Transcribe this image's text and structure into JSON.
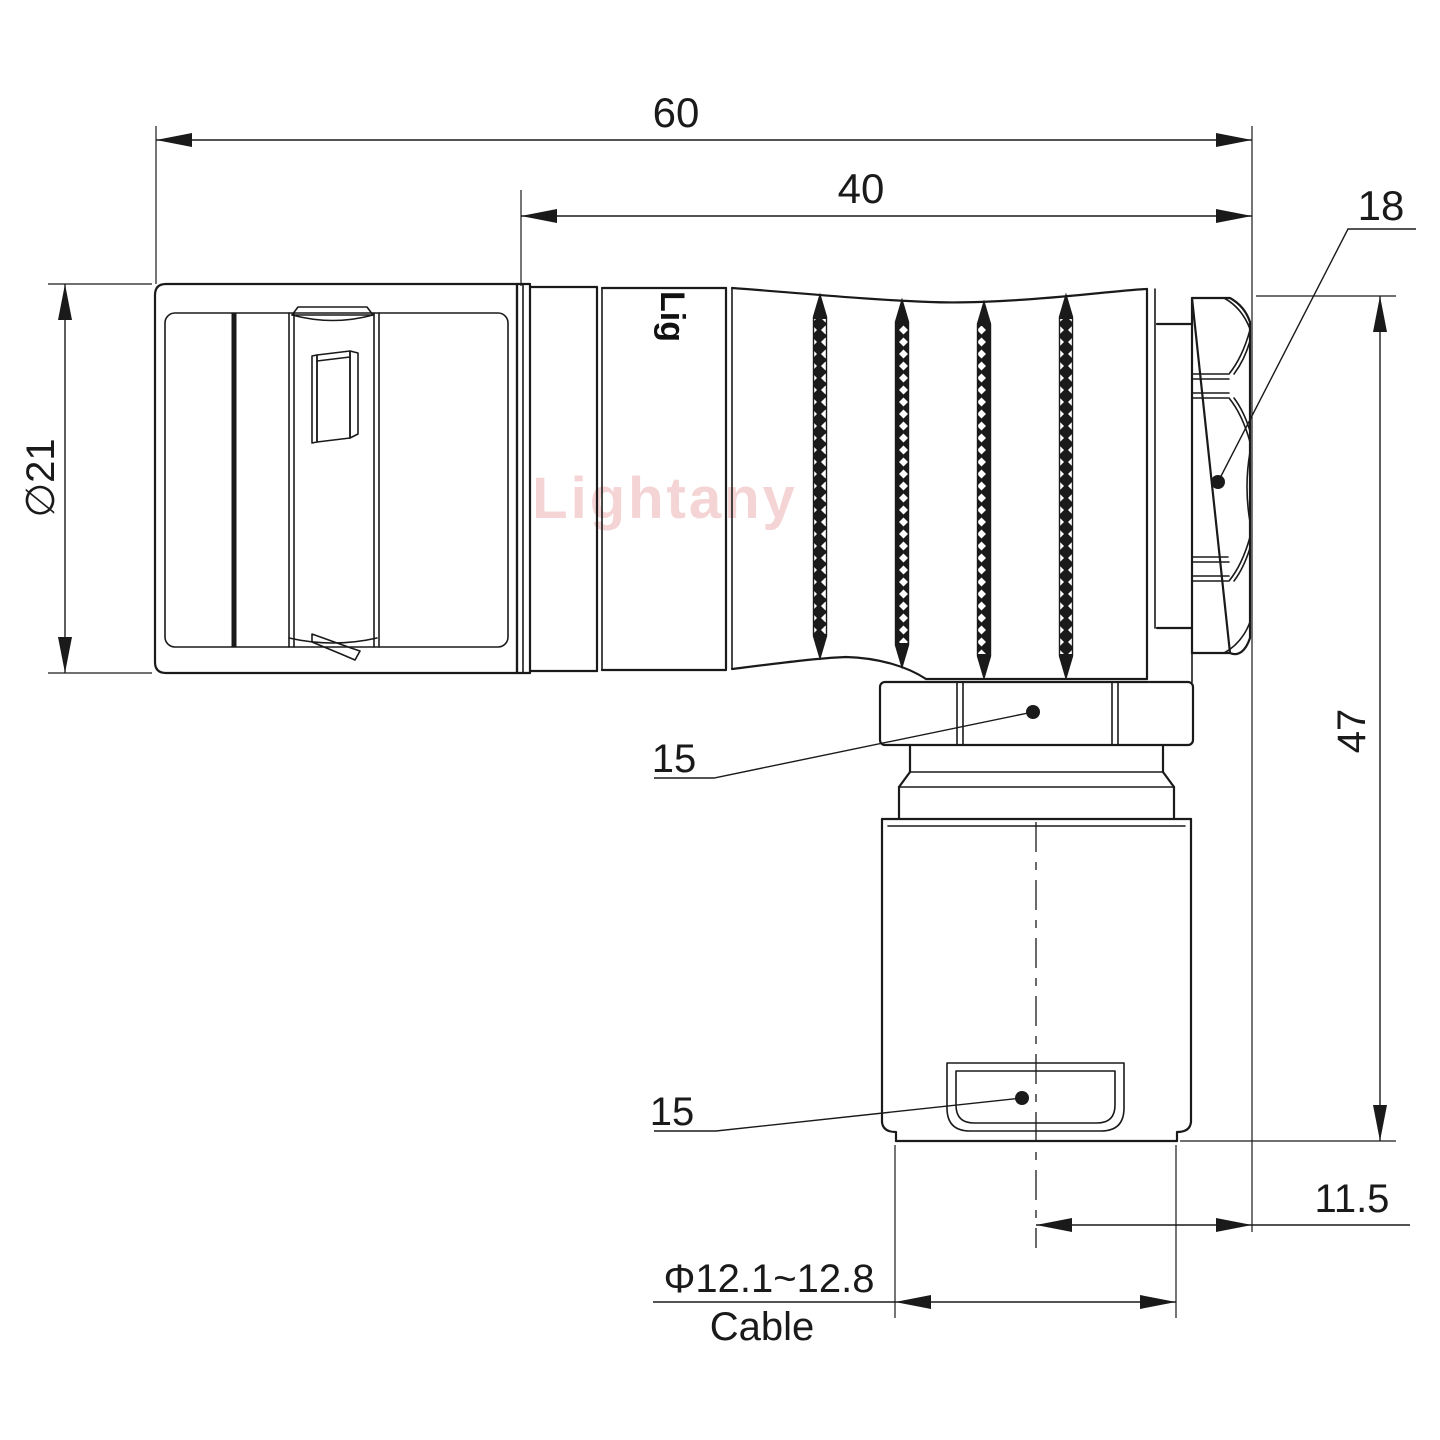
{
  "drawing": {
    "title": "Right-angle circular push-pull connector plug - dimensioned outline drawing",
    "view": "side elevation with right-angle cable exit",
    "units": "mm"
  },
  "watermark": {
    "text": "Lightany",
    "color": "#f3cdcd"
  },
  "engraving": {
    "text": "Lig"
  },
  "colors": {
    "line": "#1a1a1a",
    "background": "#ffffff",
    "watermark": "#f3cdcd"
  },
  "dimensions": {
    "total_length": {
      "value": "60",
      "meaning": "overall length of horizontal body"
    },
    "rear_length": {
      "value": "40",
      "meaning": "length from backshell joint to rear nut face"
    },
    "rear_nut": {
      "value": "18",
      "meaning": "rear hex nut size, leader with dot"
    },
    "front_diameter": {
      "value": "∅21",
      "meaning": "front shell outer diameter"
    },
    "height": {
      "value": "47",
      "meaning": "overall height from body top to cable bushing bottom"
    },
    "coupling_hex_upper": {
      "value": "15",
      "meaning": "elbow coupling hex width, leader with dot"
    },
    "cable_clamp_lower": {
      "value": "15",
      "meaning": "cable clamp hex width, leader with dot"
    },
    "cable_offset": {
      "value": "11.5",
      "meaning": "distance from vertical axis to rear face"
    },
    "cable_diameter": {
      "value": "Φ12.1~12.8",
      "meaning": "accepted cable diameter range"
    },
    "cable_label": {
      "value": "Cable"
    }
  }
}
